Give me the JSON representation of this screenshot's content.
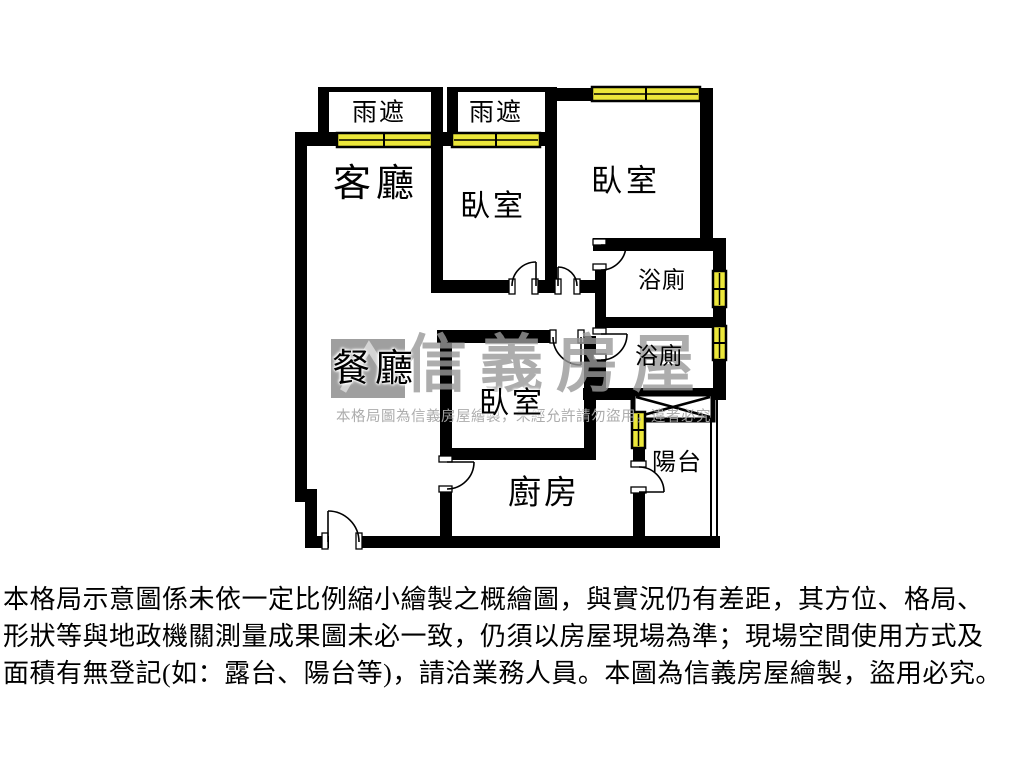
{
  "colors": {
    "wall": "#000000",
    "window_fill": "#ece73a",
    "watermark_gray": "#989898",
    "text": "#000000"
  },
  "floorplan": {
    "canopies": [
      {
        "label": "雨遮"
      },
      {
        "label": "雨遮"
      }
    ],
    "rooms": [
      {
        "id": "living-room",
        "label": "客廳"
      },
      {
        "id": "bedroom-top-middle",
        "label": "臥室"
      },
      {
        "id": "bedroom-top-right",
        "label": "臥室"
      },
      {
        "id": "bathroom-upper",
        "label": "浴廁"
      },
      {
        "id": "bathroom-lower",
        "label": "浴廁"
      },
      {
        "id": "dining-room",
        "label": "餐廳"
      },
      {
        "id": "bedroom-center",
        "label": "臥室"
      },
      {
        "id": "kitchen",
        "label": "廚房"
      },
      {
        "id": "balcony",
        "label": "陽台"
      }
    ],
    "watermark": {
      "brand": "信義房屋",
      "notice": "本格局圖為信義房屋繪製，未經允許請勿盜用，違者必究"
    }
  },
  "disclaimer": {
    "lines": [
      "本格局示意圖係未依一定比例縮小繪製之概繪圖，與實況仍有差距，其方位、格局、",
      "形狀等與地政機關測量成果圖未必一致，仍須以房屋現場為準；現場空間使用方式及",
      "面積有無登記(如：露台、陽台等)，請洽業務人員。本圖為信義房屋繪製，盜用必究。"
    ]
  }
}
